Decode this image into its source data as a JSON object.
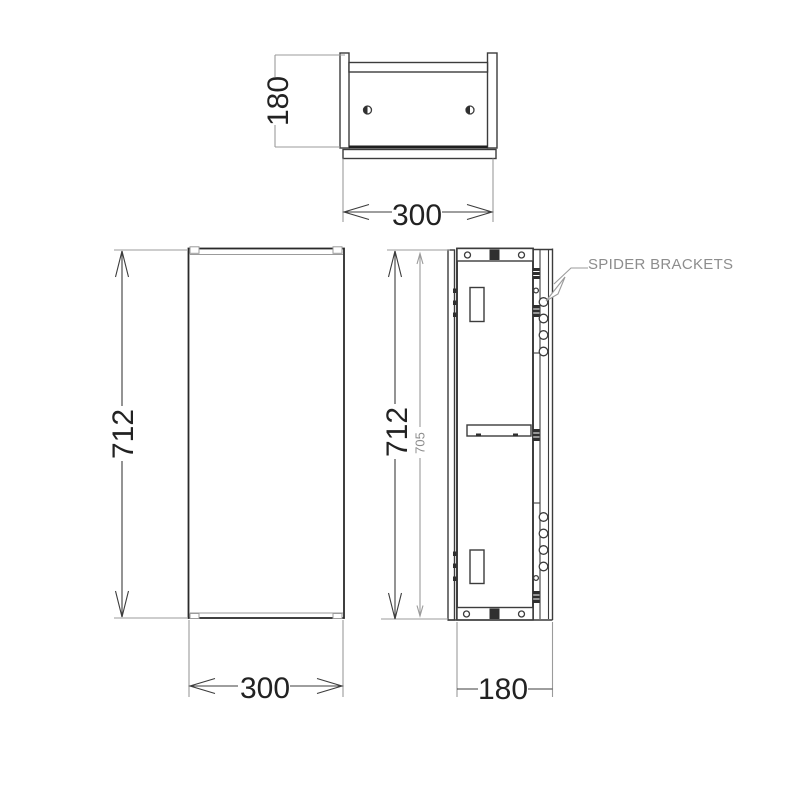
{
  "drawing": {
    "callout_label": "SPIDER BRACKETS"
  },
  "dimensions": {
    "top_view": {
      "depth": "180",
      "width": "300"
    },
    "front_view": {
      "height": "712",
      "width": "300"
    },
    "side_view": {
      "height": "712",
      "carcase_height": "705",
      "depth": "180"
    }
  },
  "colors": {
    "background": "#ffffff",
    "line_dark": "#3c3c3c",
    "line_heavy": "#1f1f1f",
    "line_light": "#9b9b9b",
    "dimension_text": "#222222",
    "annotation_text": "#8d8d8d"
  }
}
